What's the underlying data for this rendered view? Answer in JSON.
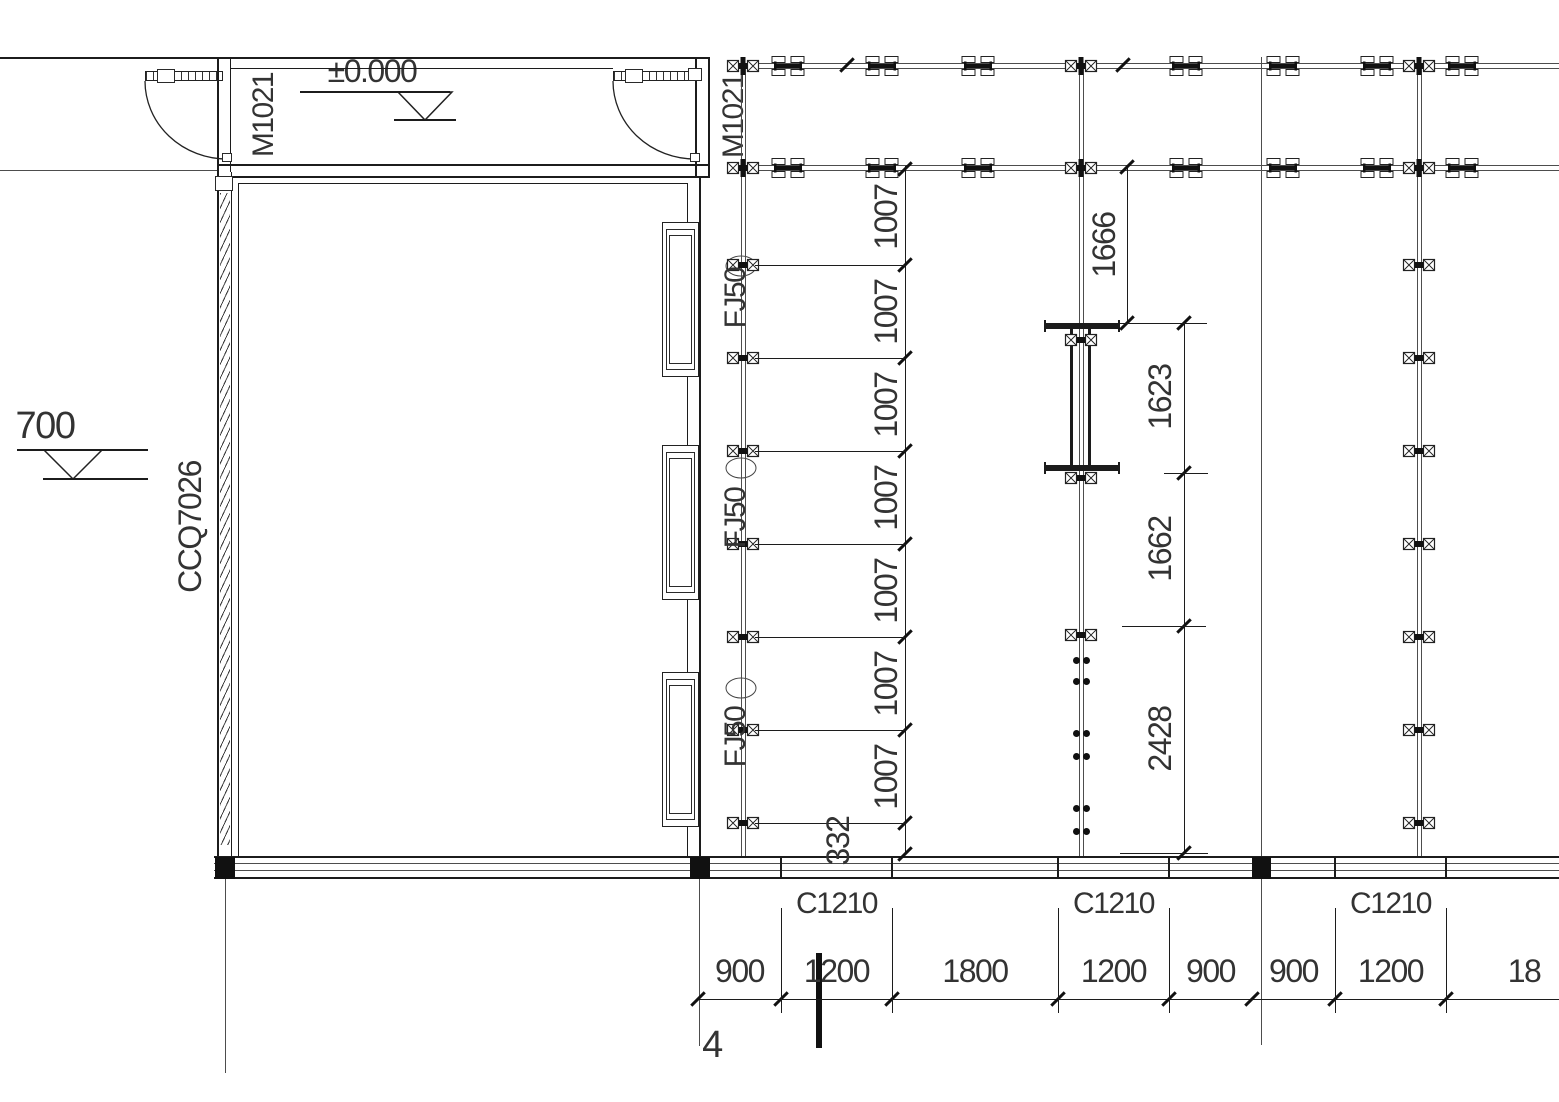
{
  "drawing": {
    "doors": {
      "left": "M1021",
      "right": "M1021"
    },
    "levels": {
      "zero": "±0.000",
      "entry": "700"
    },
    "curtain_wall": "CCQ7026",
    "grid_axis": "4",
    "stud_tags": [
      "FJ50",
      "FJ50",
      "FJ50"
    ],
    "dims": {
      "stud_spacing": [
        "1007",
        "1007",
        "1007",
        "1007",
        "1007",
        "1007",
        "1007"
      ],
      "stud_tail": "332",
      "mid": [
        "1666",
        "1623",
        "1662",
        "2428"
      ],
      "bottom": [
        "900",
        "1200",
        "1800",
        "1200",
        "900",
        "900",
        "1200",
        "18"
      ],
      "window_tags": [
        "C1210",
        "C1210",
        "C1210"
      ]
    }
  }
}
